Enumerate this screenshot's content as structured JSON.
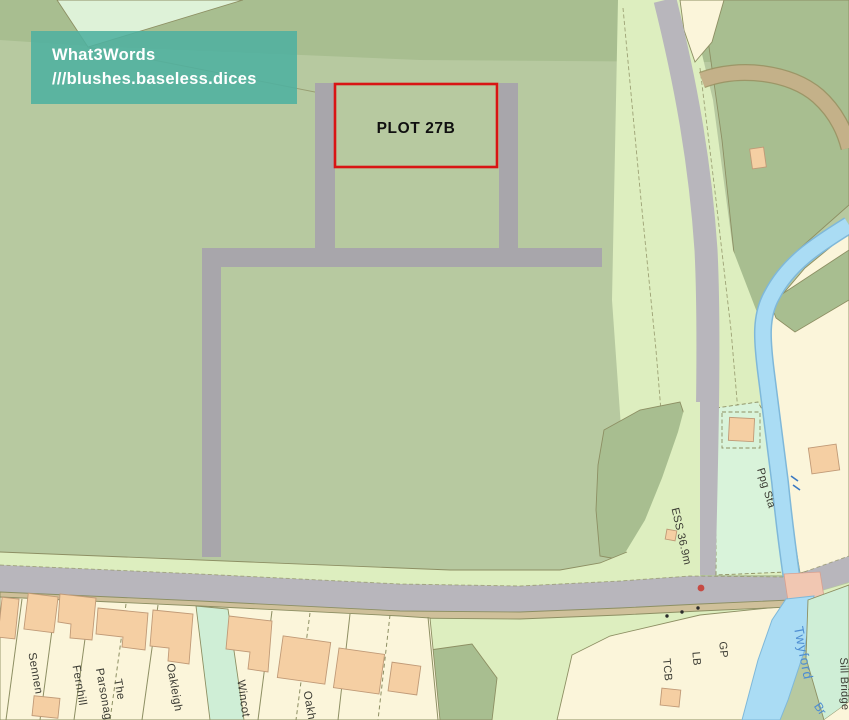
{
  "overlay": {
    "title": "What3Words",
    "address": "///blushes.baseless.dices"
  },
  "plot": {
    "label": "PLOT 27B"
  },
  "map_labels": {
    "sennen": "Sennen",
    "fernhill": "Fernhill",
    "parsonage_line1": "The",
    "parsonage_line2": "Parsonage",
    "oakleigh": "Oakleigh",
    "wincot": "Wincot",
    "oakhurst_partial": "Oakh",
    "ess_height": "ESS 36.9m",
    "ppg_sta": "Ppg Sta",
    "tcb": "TCB",
    "lb": "LB",
    "gp": "GP",
    "twyford": "Twyford",
    "sill_bridge": "Sill Bridge",
    "brook_partial": "Br"
  },
  "colors": {
    "w3w_box": "#52b2a0",
    "plot_outline": "#d91414",
    "field_green": "#b7c9a0",
    "dark_green": "#a8be90",
    "verge_green": "#ddeebf",
    "mint_green": "#cfeed6",
    "road_gray": "#b8b6bc",
    "track_gray": "#a8a6ab",
    "river_blue": "#aadcf4",
    "building_tan": "#f5cfa3",
    "plot_yellow": "#fbf5da",
    "track_brown": "#c4b189"
  }
}
